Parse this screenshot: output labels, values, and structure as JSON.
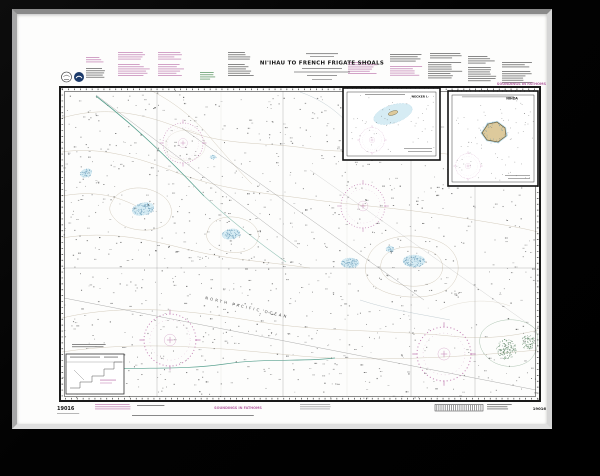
{
  "chart": {
    "title": "NI'IHAU TO FRENCH FRIGATE SHOALS",
    "soundings_top_right": "SOUNDINGS IN FATHOMS",
    "soundings_bottom": "SOUNDINGS IN FATHOMS",
    "chart_number_bottom_left": "19016",
    "chart_number_bottom_right": "19016",
    "ocean_label": "NORTH PACIFIC OCEAN",
    "insets": {
      "necker": {
        "title": "NECKER I."
      },
      "nihoa": {
        "title": "NIHOA"
      }
    },
    "colors": {
      "magenta": "#b665a4",
      "shoal_blue_fill": "#d6ecf4",
      "shoal_blue_stipple": "#4e86a8",
      "land_tan": "#ddca9c",
      "teal_contour": "#57a08e",
      "reef_green": "#3e6e49",
      "contour_gray": "#c9c0ae",
      "sounding_dot": "#4a4a4a"
    }
  }
}
